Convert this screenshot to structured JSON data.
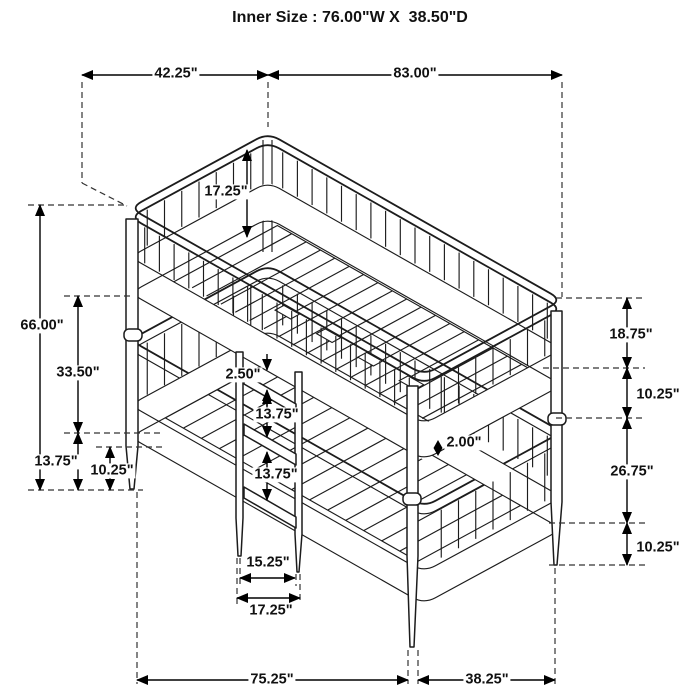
{
  "title": "Inner Size : 76.00\"W X  38.50\"D",
  "dims": {
    "top_width_left": "42.25\"",
    "top_width_right": "83.00\"",
    "height_total": "66.00\"",
    "height_upper_to_lower": "33.50\"",
    "height_lower_rail": "13.75\"",
    "clearance_left": "10.25\"",
    "upper_rail_depth": "17.25\"",
    "ladder_gap_small": "2.50\"",
    "ladder_gap_1": "13.75\"",
    "ladder_gap_2": "13.75\"",
    "slat_thickness": "2.00\"",
    "right_upper": "18.75\"",
    "right_gap": "10.25\"",
    "right_lower": "26.75\"",
    "right_clearance": "10.25\"",
    "ladder_width_inner": "15.25\"",
    "ladder_width_outer": "17.25\"",
    "base_length": "75.25\"",
    "base_depth": "38.25\""
  }
}
